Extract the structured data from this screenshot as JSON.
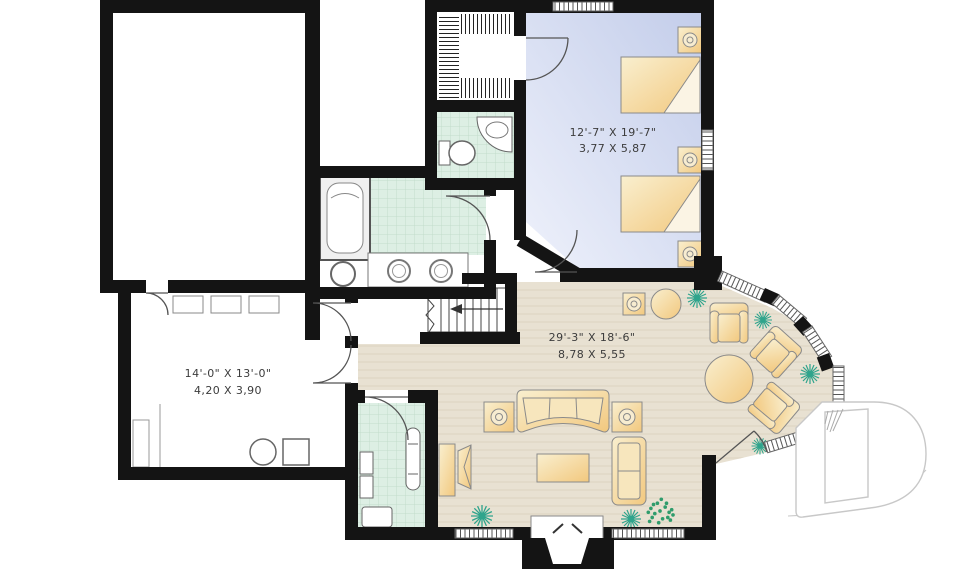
{
  "floor_plan": {
    "labels": {
      "bedroom": {
        "imperial": "12'-7\" X 19'-7\"",
        "metric": "3,77 X 5,87"
      },
      "living_area": {
        "imperial": "29'-3\" X 18'-6\"",
        "metric": "8,78 X 5,55"
      },
      "utility_room": {
        "imperial": "14'-0\" X 13'-0\"",
        "metric": "4,20 X 3,90"
      }
    },
    "colors": {
      "wall": "#141414",
      "bedroom_floor_dark": "#c3cdea",
      "bedroom_floor_light": "#eef1fb",
      "living_floor": "#e8e1d2",
      "wood_line": "#d9d0bc",
      "tile": "#ddefe4",
      "tile_line": "#c2dccb",
      "furniture_dark": "#f2c87e",
      "furniture_light": "#f9efcf",
      "plant": "#2fa48c",
      "logo_outline": "#c8c8c8",
      "label_text": "#3c3c3c"
    },
    "logo": "drummond-d-monogram"
  }
}
